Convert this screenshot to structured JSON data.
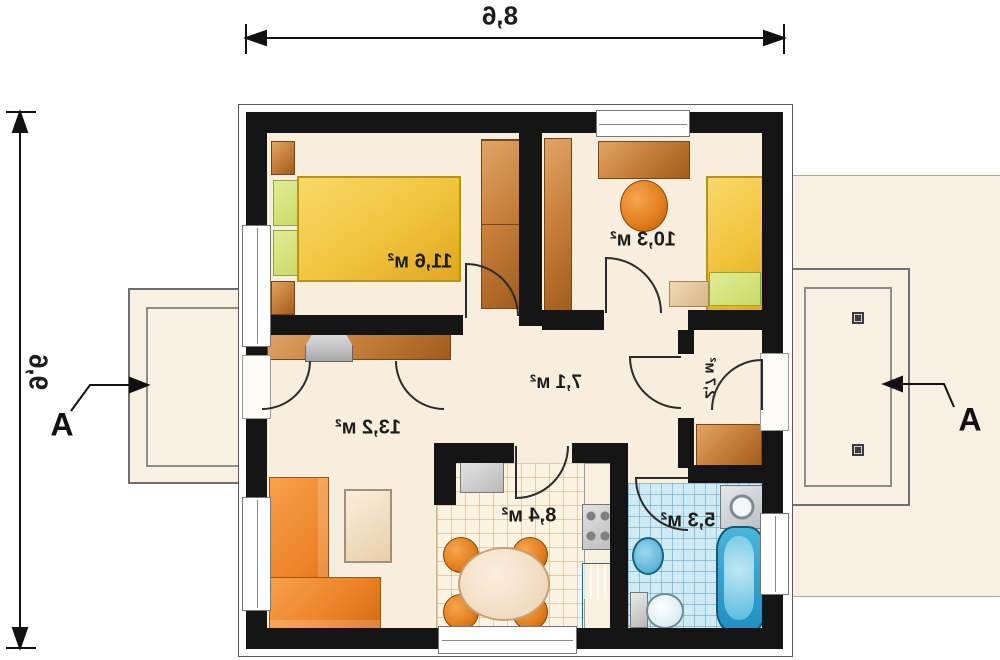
{
  "dimensions": {
    "width": "8,6",
    "height": "9,6"
  },
  "section_marks": {
    "left": "A",
    "right": "A"
  },
  "rooms": {
    "bedroom_main": {
      "area": "11,6 м²"
    },
    "bedroom_second": {
      "area": "10,3 м²"
    },
    "hall": {
      "area": "7,1 м²"
    },
    "living_room": {
      "area": "13,2 м²"
    },
    "kitchen": {
      "area": "8,4 м²"
    },
    "bathroom": {
      "area": "5,3 м²"
    },
    "vestibule": {
      "area": "2,7 м²"
    }
  },
  "colors": {
    "wall": "#151515",
    "floor": "#f8eedd",
    "wood": "#c9813d",
    "wood-dark": "#a05c1c",
    "bed-yellow": "#f1c33c",
    "pillow-green": "#cbd968",
    "sofa-orange": "#ec8227",
    "tile-kitchen": "#fbf3e3",
    "tile-bath": "#cfeaf3",
    "water-blue": "#2fa7d4",
    "terrace": "#f8f0e2"
  }
}
